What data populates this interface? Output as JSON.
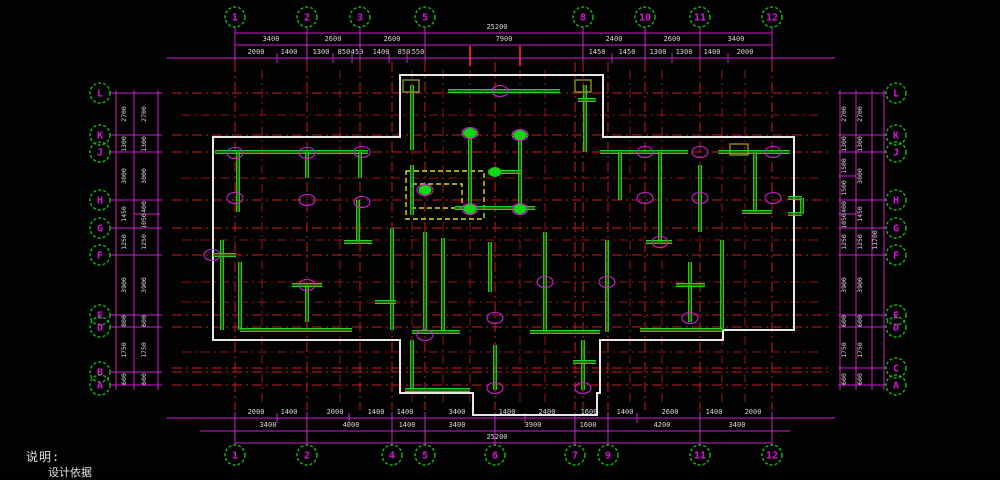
{
  "notes": {
    "line1": "说明:",
    "line2": "设计依据"
  },
  "colors": {
    "background": "#020202",
    "grid_red": "#cc1a1a",
    "grid_red_minor": "#8e1212",
    "dim_magenta": "#cf1fcf",
    "wall_green": "#1ed321",
    "wall_dark": "#466b00",
    "outline_white": "#e8e8e8",
    "dashed_yellow": "#d9d91e",
    "dot_green": "#12d412",
    "bubble_green": "#18b818",
    "bubble_text": "#d816d8",
    "dim_text": "#d6d6d6",
    "olive": "#9a9a22"
  },
  "axes": {
    "top_y": 17,
    "top": [
      {
        "label": "1",
        "x": 235
      },
      {
        "label": "2",
        "x": 307
      },
      {
        "label": "3",
        "x": 360
      },
      {
        "label": "5",
        "x": 425
      },
      {
        "label": "8",
        "x": 583
      },
      {
        "label": "10",
        "x": 645
      },
      {
        "label": "11",
        "x": 700
      },
      {
        "label": "12",
        "x": 772
      }
    ],
    "bottom_y": 455,
    "bottom": [
      {
        "label": "1",
        "x": 235
      },
      {
        "label": "2",
        "x": 307
      },
      {
        "label": "4",
        "x": 392
      },
      {
        "label": "5",
        "x": 425
      },
      {
        "label": "6",
        "x": 495
      },
      {
        "label": "7",
        "x": 575
      },
      {
        "label": "9",
        "x": 608
      },
      {
        "label": "11",
        "x": 700
      },
      {
        "label": "12",
        "x": 772
      }
    ],
    "left_x": 100,
    "left": [
      {
        "label": "L",
        "y": 93
      },
      {
        "label": "K",
        "y": 135
      },
      {
        "label": "J",
        "y": 152
      },
      {
        "label": "H",
        "y": 200
      },
      {
        "label": "G",
        "y": 228
      },
      {
        "label": "F",
        "y": 255
      },
      {
        "label": "E",
        "y": 315
      },
      {
        "label": "D",
        "y": 327
      },
      {
        "label": "B",
        "y": 372
      },
      {
        "label": "A",
        "y": 385
      }
    ],
    "right_x": 896,
    "right": [
      {
        "label": "L",
        "y": 93
      },
      {
        "label": "K",
        "y": 135
      },
      {
        "label": "J",
        "y": 152
      },
      {
        "label": "H",
        "y": 200
      },
      {
        "label": "G",
        "y": 228
      },
      {
        "label": "F",
        "y": 255
      },
      {
        "label": "E",
        "y": 315
      },
      {
        "label": "D",
        "y": 327
      },
      {
        "label": "C",
        "y": 368
      },
      {
        "label": "A",
        "y": 385
      }
    ]
  },
  "dimensions": {
    "top_rows": [
      {
        "line_y": 33,
        "text_y": 29,
        "x1": 235,
        "x2": 772,
        "ticks": [],
        "labels": [
          {
            "x": 497,
            "t": "25200"
          }
        ]
      },
      {
        "line_y": 45,
        "text_y": 41,
        "x1": 235,
        "x2": 772,
        "ticks": [],
        "labels": [
          {
            "x": 271,
            "t": "3400"
          },
          {
            "x": 333,
            "t": "2600"
          },
          {
            "x": 392,
            "t": "2600"
          },
          {
            "x": 504,
            "t": "7900"
          },
          {
            "x": 614,
            "t": "2400"
          },
          {
            "x": 672,
            "t": "2600"
          },
          {
            "x": 736,
            "t": "3400"
          }
        ]
      },
      {
        "line_y": 58,
        "text_y": 54,
        "x1": 166,
        "x2": 835,
        "ticks": [
          277,
          333,
          352,
          389,
          407,
          612,
          672,
          728
        ],
        "labels": [
          {
            "x": 256,
            "t": "2000"
          },
          {
            "x": 289,
            "t": "1400"
          },
          {
            "x": 321,
            "t": "1300"
          },
          {
            "x": 344,
            "t": "850"
          },
          {
            "x": 357,
            "t": "450"
          },
          {
            "x": 381,
            "t": "1400"
          },
          {
            "x": 404,
            "t": "850"
          },
          {
            "x": 418,
            "t": "550"
          },
          {
            "x": 597,
            "t": "1450"
          },
          {
            "x": 627,
            "t": "1450"
          },
          {
            "x": 658,
            "t": "1300"
          },
          {
            "x": 684,
            "t": "1300"
          },
          {
            "x": 712,
            "t": "1400"
          },
          {
            "x": 745,
            "t": "2000"
          }
        ]
      }
    ],
    "bottom_rows": [
      {
        "line_y": 418,
        "text_y": 414,
        "x1": 166,
        "x2": 835,
        "ticks": [
          277,
          349,
          525,
          637
        ],
        "labels": [
          {
            "x": 256,
            "t": "2000"
          },
          {
            "x": 289,
            "t": "1400"
          },
          {
            "x": 335,
            "t": "2000"
          },
          {
            "x": 376,
            "t": "1400"
          },
          {
            "x": 405,
            "t": "1400"
          },
          {
            "x": 457,
            "t": "3400"
          },
          {
            "x": 507,
            "t": "1400"
          },
          {
            "x": 547,
            "t": "2400"
          },
          {
            "x": 589,
            "t": "1600"
          },
          {
            "x": 625,
            "t": "1400"
          },
          {
            "x": 670,
            "t": "2600"
          },
          {
            "x": 714,
            "t": "1400"
          },
          {
            "x": 753,
            "t": "2000"
          }
        ]
      },
      {
        "line_y": 431,
        "text_y": 427,
        "x1": 200,
        "x2": 790,
        "ticks": [],
        "labels": [
          {
            "x": 268,
            "t": "3400"
          },
          {
            "x": 351,
            "t": "4000"
          },
          {
            "x": 407,
            "t": "1400"
          },
          {
            "x": 457,
            "t": "3400"
          },
          {
            "x": 533,
            "t": "3900"
          },
          {
            "x": 588,
            "t": "1600"
          },
          {
            "x": 662,
            "t": "4200"
          },
          {
            "x": 737,
            "t": "3400"
          }
        ]
      },
      {
        "line_y": 443,
        "text_y": 439,
        "x1": 235,
        "x2": 772,
        "ticks": [],
        "labels": [
          {
            "x": 497,
            "t": "25200"
          }
        ]
      }
    ],
    "left_cols": {
      "lines_x": [
        116,
        134,
        158
      ],
      "y1": 90,
      "y2": 390,
      "sub_ticks": [
        {
          "y": 214,
          "x1": 134,
          "x2": 160
        }
      ],
      "labels": [
        {
          "x": 126,
          "y": 114,
          "t": "2700"
        },
        {
          "x": 126,
          "y": 144,
          "t": "1300"
        },
        {
          "x": 126,
          "y": 176,
          "t": "3000"
        },
        {
          "x": 126,
          "y": 214,
          "t": "1450"
        },
        {
          "x": 126,
          "y": 242,
          "t": "1250"
        },
        {
          "x": 126,
          "y": 285,
          "t": "3900"
        },
        {
          "x": 126,
          "y": 321,
          "t": "800"
        },
        {
          "x": 126,
          "y": 350,
          "t": "1750"
        },
        {
          "x": 126,
          "y": 379,
          "t": "600"
        },
        {
          "x": 146,
          "y": 114,
          "t": "2700"
        },
        {
          "x": 146,
          "y": 144,
          "t": "1300"
        },
        {
          "x": 146,
          "y": 176,
          "t": "3000"
        },
        {
          "x": 146,
          "y": 207,
          "t": "400"
        },
        {
          "x": 146,
          "y": 221,
          "t": "1050"
        },
        {
          "x": 146,
          "y": 242,
          "t": "1250"
        },
        {
          "x": 146,
          "y": 285,
          "t": "3900"
        },
        {
          "x": 146,
          "y": 321,
          "t": "600"
        },
        {
          "x": 146,
          "y": 350,
          "t": "1750"
        },
        {
          "x": 146,
          "y": 379,
          "t": "600"
        }
      ]
    },
    "right_cols": {
      "lines_x": [
        840,
        856,
        872,
        884
      ],
      "y1": 90,
      "y2": 390,
      "sub_ticks": [
        {
          "y": 176,
          "x1": 838,
          "x2": 856
        },
        {
          "y": 214,
          "x1": 838,
          "x2": 856
        }
      ],
      "labels": [
        {
          "x": 846,
          "y": 114,
          "t": "2700"
        },
        {
          "x": 846,
          "y": 144,
          "t": "1300"
        },
        {
          "x": 846,
          "y": 166,
          "t": "1500"
        },
        {
          "x": 846,
          "y": 188,
          "t": "1500"
        },
        {
          "x": 846,
          "y": 207,
          "t": "400"
        },
        {
          "x": 846,
          "y": 221,
          "t": "1050"
        },
        {
          "x": 846,
          "y": 242,
          "t": "1250"
        },
        {
          "x": 846,
          "y": 285,
          "t": "3900"
        },
        {
          "x": 846,
          "y": 321,
          "t": "600"
        },
        {
          "x": 846,
          "y": 350,
          "t": "1750"
        },
        {
          "x": 846,
          "y": 379,
          "t": "600"
        },
        {
          "x": 862,
          "y": 114,
          "t": "2700"
        },
        {
          "x": 862,
          "y": 144,
          "t": "1300"
        },
        {
          "x": 862,
          "y": 176,
          "t": "3000"
        },
        {
          "x": 862,
          "y": 214,
          "t": "1450"
        },
        {
          "x": 862,
          "y": 242,
          "t": "1250"
        },
        {
          "x": 862,
          "y": 285,
          "t": "3900"
        },
        {
          "x": 862,
          "y": 321,
          "t": "600"
        },
        {
          "x": 862,
          "y": 350,
          "t": "1750"
        },
        {
          "x": 862,
          "y": 379,
          "t": "600"
        },
        {
          "x": 877,
          "y": 240,
          "t": "11700"
        }
      ]
    }
  },
  "plan": {
    "outline": [
      [
        213,
        137
      ],
      [
        400,
        137
      ],
      [
        400,
        75
      ],
      [
        603,
        75
      ],
      [
        603,
        137
      ],
      [
        794,
        137
      ],
      [
        794,
        330
      ],
      [
        723,
        330
      ],
      [
        723,
        340
      ],
      [
        600,
        340
      ],
      [
        600,
        393
      ],
      [
        597,
        393
      ],
      [
        597,
        415
      ],
      [
        473,
        415
      ],
      [
        473,
        393
      ],
      [
        400,
        393
      ],
      [
        400,
        340
      ],
      [
        213,
        340
      ]
    ],
    "red_grid": {
      "v_main": [
        235,
        307,
        360,
        392,
        425,
        495,
        575,
        583,
        608,
        645,
        700,
        772
      ],
      "v_minor": [
        262,
        340,
        412,
        443,
        470,
        520,
        545,
        630,
        662,
        722,
        745
      ],
      "h_main": [
        93,
        135,
        152,
        200,
        228,
        255,
        315,
        327,
        368,
        372,
        385
      ],
      "h_minor": [
        115,
        178,
        240,
        282,
        302,
        352
      ],
      "v_y1": 62,
      "v_y2": 410,
      "h_x1": 172,
      "h_x2": 830,
      "stubs": [
        [
          470,
          46,
          66
        ],
        [
          520,
          46,
          66
        ]
      ]
    },
    "walls": [
      [
        448,
        91,
        560,
        91
      ],
      [
        412,
        85,
        412,
        150
      ],
      [
        585,
        85,
        585,
        152
      ],
      [
        470,
        130,
        470,
        212
      ],
      [
        520,
        133,
        520,
        210
      ],
      [
        462,
        133,
        478,
        133
      ],
      [
        512,
        135,
        528,
        135
      ],
      [
        488,
        172,
        522,
        172
      ],
      [
        455,
        208,
        535,
        208
      ],
      [
        578,
        100,
        596,
        100
      ],
      [
        215,
        152,
        368,
        152
      ],
      [
        238,
        152,
        238,
        212
      ],
      [
        307,
        152,
        307,
        178
      ],
      [
        360,
        152,
        360,
        178
      ],
      [
        222,
        240,
        222,
        330
      ],
      [
        213,
        255,
        236,
        255
      ],
      [
        240,
        262,
        240,
        330
      ],
      [
        240,
        330,
        352,
        330
      ],
      [
        307,
        285,
        307,
        322
      ],
      [
        292,
        285,
        322,
        285
      ],
      [
        358,
        200,
        358,
        242
      ],
      [
        344,
        242,
        372,
        242
      ],
      [
        392,
        228,
        392,
        330
      ],
      [
        375,
        302,
        396,
        302
      ],
      [
        412,
        165,
        412,
        215
      ],
      [
        425,
        232,
        425,
        330
      ],
      [
        412,
        332,
        460,
        332
      ],
      [
        443,
        238,
        443,
        330
      ],
      [
        490,
        242,
        490,
        292
      ],
      [
        545,
        232,
        545,
        332
      ],
      [
        530,
        332,
        600,
        332
      ],
      [
        495,
        345,
        495,
        390
      ],
      [
        412,
        340,
        412,
        390
      ],
      [
        405,
        390,
        470,
        390
      ],
      [
        583,
        340,
        583,
        390
      ],
      [
        573,
        362,
        596,
        362
      ],
      [
        600,
        152,
        688,
        152
      ],
      [
        718,
        152,
        790,
        152
      ],
      [
        620,
        152,
        620,
        200
      ],
      [
        660,
        152,
        660,
        242
      ],
      [
        646,
        242,
        672,
        242
      ],
      [
        700,
        165,
        700,
        232
      ],
      [
        755,
        152,
        755,
        212
      ],
      [
        742,
        212,
        772,
        212
      ],
      [
        722,
        240,
        722,
        330
      ],
      [
        690,
        262,
        690,
        322
      ],
      [
        676,
        285,
        705,
        285
      ],
      [
        640,
        330,
        722,
        330
      ],
      [
        607,
        240,
        607,
        332
      ],
      [
        788,
        198,
        802,
        198
      ],
      [
        802,
        198,
        802,
        214
      ],
      [
        788,
        214,
        802,
        214
      ]
    ],
    "olive_rects": [
      [
        403,
        80,
        16,
        12
      ],
      [
        575,
        80,
        16,
        12
      ],
      [
        730,
        144,
        18,
        11
      ]
    ],
    "dots": [
      [
        470,
        133
      ],
      [
        520,
        135
      ],
      [
        495,
        172
      ],
      [
        425,
        190
      ],
      [
        470,
        209
      ],
      [
        520,
        209
      ]
    ],
    "junctions": [
      [
        235,
        153
      ],
      [
        307,
        153
      ],
      [
        362,
        152
      ],
      [
        235,
        198
      ],
      [
        307,
        200
      ],
      [
        362,
        202
      ],
      [
        212,
        255
      ],
      [
        307,
        285
      ],
      [
        425,
        335
      ],
      [
        495,
        318
      ],
      [
        495,
        388
      ],
      [
        583,
        388
      ],
      [
        607,
        282
      ],
      [
        645,
        152
      ],
      [
        700,
        152
      ],
      [
        773,
        152
      ],
      [
        645,
        198
      ],
      [
        700,
        198
      ],
      [
        773,
        198
      ],
      [
        660,
        242
      ],
      [
        500,
        91
      ],
      [
        690,
        318
      ],
      [
        545,
        282
      ],
      [
        470,
        133
      ],
      [
        520,
        135
      ],
      [
        470,
        209
      ],
      [
        520,
        209
      ],
      [
        425,
        190
      ]
    ],
    "dashed_rects": [
      [
        406,
        171,
        78,
        48
      ],
      [
        412,
        184,
        50,
        24
      ]
    ]
  }
}
